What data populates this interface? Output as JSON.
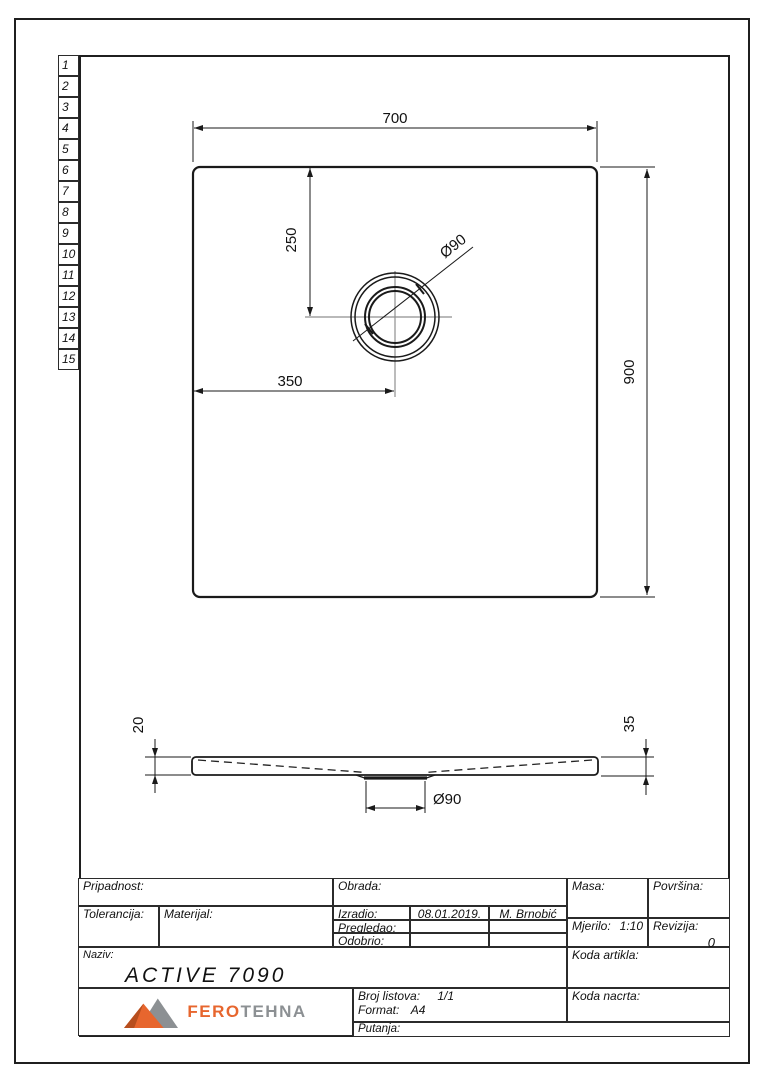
{
  "sheet": {
    "row_numbers": [
      "1",
      "2",
      "3",
      "4",
      "5",
      "6",
      "7",
      "8",
      "9",
      "10",
      "11",
      "12",
      "13",
      "14",
      "15"
    ]
  },
  "drawing": {
    "top_view": {
      "width": "700",
      "height": "900",
      "drain_offset_top": "250",
      "drain_offset_left": "350",
      "drain_diameter": "Ø90"
    },
    "section_view": {
      "rim_thickness": "20",
      "total_height": "35",
      "drain_diameter": "Ø90"
    }
  },
  "title_block": {
    "pripadnost_label": "Pripadnost:",
    "tolerancija_label": "Tolerancija:",
    "materijal_label": "Materijal:",
    "obrada_label": "Obrada:",
    "izradio_label": "Izradio:",
    "izradio_date": "08.01.2019.",
    "izradio_name": "M. Brnobić",
    "pregledao_label": "Pregledao:",
    "odobrio_label": "Odobrio:",
    "masa_label": "Masa:",
    "povrsina_label": "Površina:",
    "mjerilo_label": "Mjerilo:",
    "mjerilo_value": "1:10",
    "revizija_label": "Revizija:",
    "revizija_value": "0",
    "naziv_label": "Naziv:",
    "naziv_value": "ACTIVE 7090",
    "koda_artikla_label": "Koda artikla:",
    "koda_nacrta_label": "Koda nacrta:",
    "broj_listova_label": "Broj listova:",
    "broj_listova_value": "1/1",
    "format_label": "Format:",
    "format_value": "A4",
    "putanja_label": "Putanja:"
  },
  "logo": {
    "brand_first": "FERO",
    "brand_second": "TEHNA",
    "orange": "#E7662E",
    "dark_orange": "#B74E1E",
    "gray": "#8C9093"
  }
}
